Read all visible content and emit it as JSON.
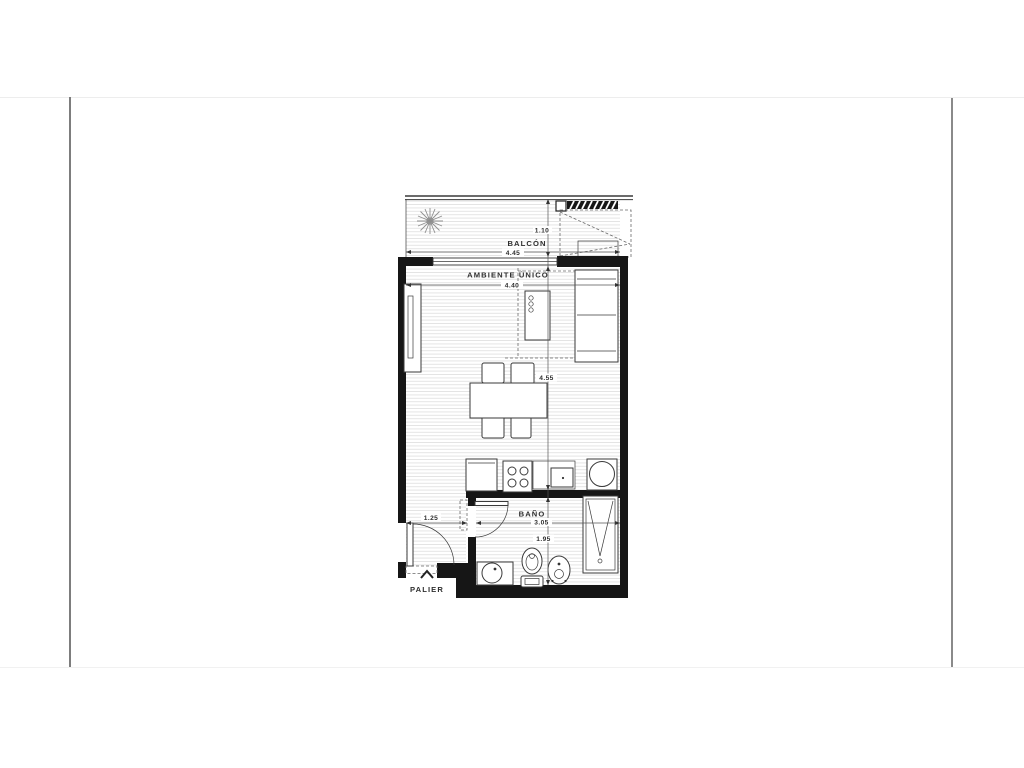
{
  "colors": {
    "wall": "#161616",
    "line": "#3a3a3a",
    "hatch": "#e2e2e2",
    "text": "#2e2e2e",
    "frame": "#8a8a8a"
  },
  "plan": {
    "rooms": {
      "balcony": {
        "label": "BALCÓN",
        "width": "4.45",
        "depth": "1.10"
      },
      "main_room": {
        "label": "AMBIENTE ÚNICO",
        "width": "4.40",
        "depth": "4.55"
      },
      "bathroom": {
        "label": "BAÑO",
        "width": "3.05",
        "depth": "1.95"
      },
      "entry": {
        "width": "1.25"
      },
      "landing": {
        "label": "PALIER"
      }
    }
  }
}
